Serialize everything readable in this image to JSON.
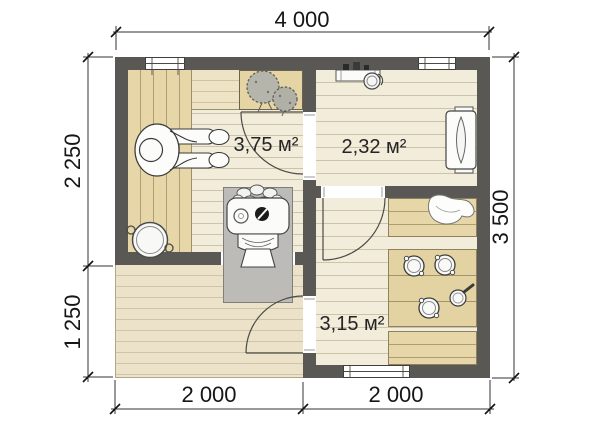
{
  "title": "Bathhouse floor plan",
  "dimensions": {
    "top_width": "4 000",
    "right_height": "3 500",
    "left_upper": "2 250",
    "left_lower": "1 250",
    "bottom_left": "2 000",
    "bottom_right": "2 000"
  },
  "rooms": {
    "sauna": {
      "area": "3,75 м²"
    },
    "rest": {
      "area": "2,32 м²"
    },
    "wash": {
      "area": "3,15 м²"
    }
  },
  "fixtures": [
    "sauna-bench",
    "person-on-bench",
    "plants",
    "sauna-stove",
    "wooden-tub",
    "lounger",
    "shelf-with-bucket",
    "wash-basins",
    "ladle",
    "towel",
    "wash-benches",
    "door-swings",
    "windows",
    "terrace-deck"
  ],
  "colors": {
    "wall": "#5a5855",
    "floor_cream": "#f2ecda",
    "floor_line": "#ccc4aa",
    "bench_tan": "#e7d7a8",
    "bench_line": "#af9e74",
    "terrace": "#ebe2c9",
    "terrace_line": "#cec4a6",
    "table_tan": "#e3d3a2",
    "table_line": "#a4936a",
    "pad_gray": "#bdbbb8",
    "dim_text": "#161616"
  }
}
